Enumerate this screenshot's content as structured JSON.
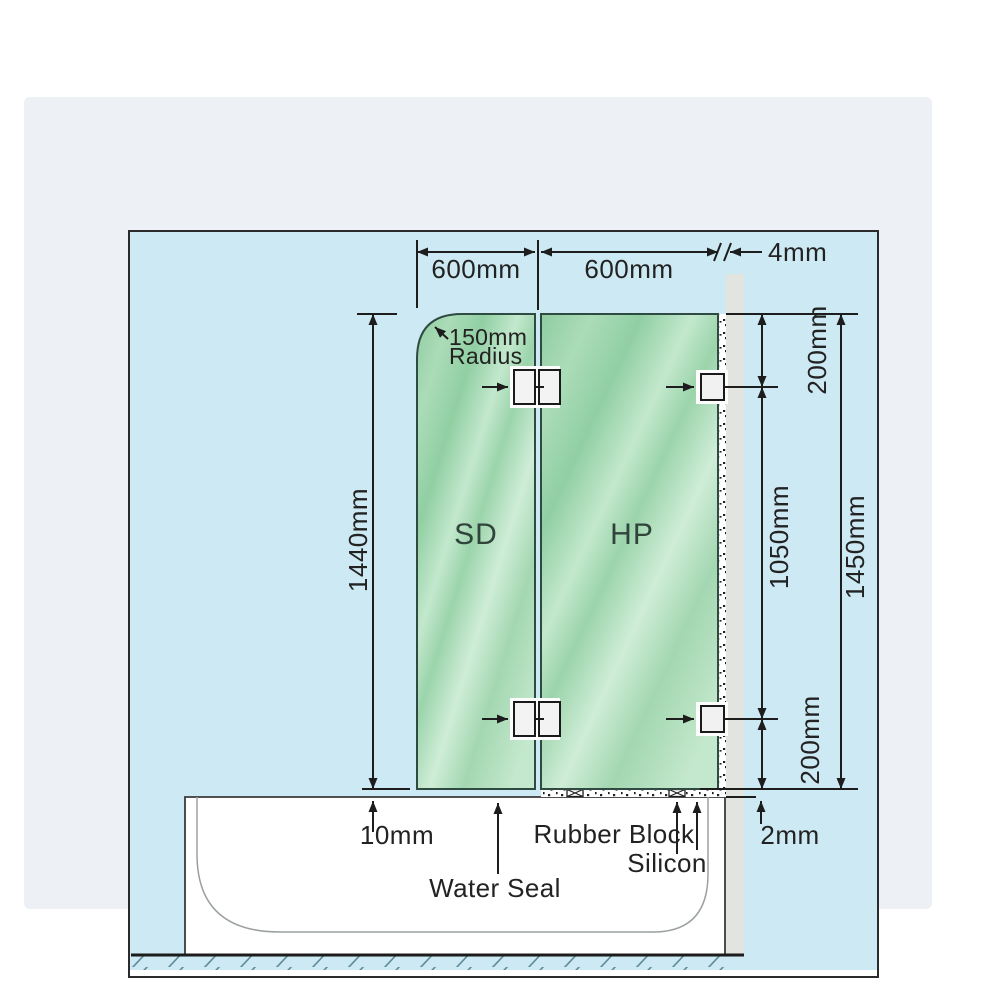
{
  "diagram": {
    "background": "#cde9f3",
    "frame_background": "#edf0f4",
    "line_color": "#222222",
    "wall_color": "#e2e4df",
    "glass_color_dark": "#8fcca0",
    "glass_color_light": "#cfedd7",
    "panels": {
      "shower_door": "SD",
      "hinge_panel": "HP"
    },
    "dimensions": {
      "sd_width": "600mm",
      "hp_width": "600mm",
      "wall_gap": "4mm",
      "corner_radius_line1": "150mm",
      "corner_radius_line2": "Radius",
      "sd_height": "1440mm",
      "top_bracket_offset": "200mm",
      "bracket_spacing": "1050mm",
      "hp_height": "1450mm",
      "bottom_bracket_offset": "200mm",
      "door_bottom_gap": "10mm",
      "silicon_gap": "2mm"
    },
    "callouts": {
      "water_seal": "Water Seal",
      "rubber_block": "Rubber Block",
      "silicon": "Silicon"
    }
  }
}
